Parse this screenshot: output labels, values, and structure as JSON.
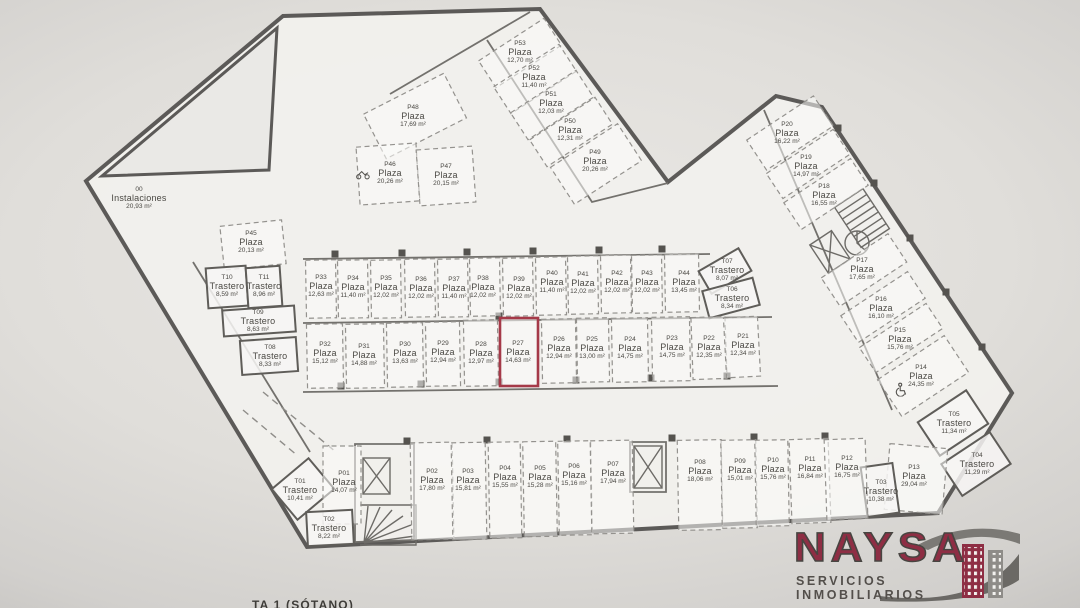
{
  "colors": {
    "wall": "#5c5a58",
    "highlight": "#a53948",
    "logo_maroon": "#8e2e44",
    "logo_gray": "#6b6965",
    "floor": "#f1f0ed",
    "background": "#d6d4d2",
    "label_text": "#4a4843"
  },
  "logo": {
    "name": "NAYSA",
    "tagline": "SERVICIOS INMOBILIARIOS"
  },
  "caption": {
    "text": "TA 1 (SÓTANO)"
  },
  "units": {
    "plaza": "Plaza",
    "trastero": "Trastero",
    "instalaciones": "Instalaciones",
    "area_suffix": "m²"
  },
  "rooms": [
    {
      "id": "P53",
      "kind": "plaza",
      "area": "12,70",
      "label": {
        "x": 520,
        "y": 53
      },
      "rect": {
        "cx": 520,
        "cy": 53,
        "w": 78,
        "h": 32,
        "rot": -33
      }
    },
    {
      "id": "P52",
      "kind": "plaza",
      "area": "11,40",
      "label": {
        "x": 534,
        "y": 78
      },
      "rect": {
        "cx": 535,
        "cy": 79,
        "w": 78,
        "h": 32,
        "rot": -33
      }
    },
    {
      "id": "P51",
      "kind": "plaza",
      "area": "12,03",
      "label": {
        "x": 551,
        "y": 104
      },
      "rect": {
        "cx": 552,
        "cy": 105,
        "w": 78,
        "h": 32,
        "rot": -33
      }
    },
    {
      "id": "P50",
      "kind": "plaza",
      "area": "12,31",
      "label": {
        "x": 570,
        "y": 131
      },
      "rect": {
        "cx": 571,
        "cy": 132,
        "w": 78,
        "h": 32,
        "rot": -33
      }
    },
    {
      "id": "P49",
      "kind": "plaza",
      "area": "20,26",
      "label": {
        "x": 595,
        "y": 162
      },
      "rect": {
        "cx": 596,
        "cy": 164,
        "w": 80,
        "h": 44,
        "rot": -33
      }
    },
    {
      "id": "P48",
      "kind": "plaza",
      "area": "17,69",
      "label": {
        "x": 413,
        "y": 117
      },
      "rect": {
        "cx": 415,
        "cy": 116,
        "w": 90,
        "h": 50,
        "rot": -27
      }
    },
    {
      "id": "P46",
      "kind": "plaza",
      "area": "20,26",
      "label": {
        "x": 390,
        "y": 174
      },
      "rect": {
        "cx": 388,
        "cy": 174,
        "w": 60,
        "h": 58,
        "rot": -4
      },
      "icon": "motorcycle",
      "icon_pos": {
        "x": 363,
        "y": 176
      }
    },
    {
      "id": "P47",
      "kind": "plaza",
      "area": "20,15",
      "label": {
        "x": 446,
        "y": 176
      },
      "rect": {
        "cx": 446,
        "cy": 176,
        "w": 56,
        "h": 56,
        "rot": -4
      }
    },
    {
      "id": "P45",
      "kind": "plaza",
      "area": "20,13",
      "label": {
        "x": 251,
        "y": 243
      },
      "rect": {
        "cx": 253,
        "cy": 245,
        "w": 62,
        "h": 44,
        "rot": -6
      }
    },
    {
      "id": "00",
      "kind": "instalaciones",
      "area": "20,93",
      "label": {
        "x": 139,
        "y": 199
      }
    },
    {
      "id": "T10",
      "kind": "trastero",
      "area": "8,59",
      "label": {
        "x": 227,
        "y": 287
      },
      "rect": {
        "cx": 227,
        "cy": 287,
        "w": 40,
        "h": 40,
        "rot": -4
      }
    },
    {
      "id": "T11",
      "kind": "trastero",
      "area": "8,96",
      "label": {
        "x": 264,
        "y": 287
      },
      "rect": {
        "cx": 264,
        "cy": 287,
        "w": 34,
        "h": 40,
        "rot": -4
      }
    },
    {
      "id": "T09",
      "kind": "trastero",
      "area": "8,63",
      "label": {
        "x": 258,
        "y": 322
      },
      "rect": {
        "cx": 259,
        "cy": 321,
        "w": 72,
        "h": 26,
        "rot": -4
      }
    },
    {
      "id": "T08",
      "kind": "trastero",
      "area": "8,33",
      "label": {
        "x": 270,
        "y": 357
      },
      "rect": {
        "cx": 269,
        "cy": 356,
        "w": 56,
        "h": 34,
        "rot": -4
      }
    },
    {
      "id": "P33",
      "kind": "plaza",
      "area": "12,63",
      "label": {
        "x": 321,
        "y": 287
      },
      "rect": {
        "cx": 321,
        "cy": 289,
        "w": 30,
        "h": 58,
        "rot": -1
      }
    },
    {
      "id": "P34",
      "kind": "plaza",
      "area": "11,40",
      "label": {
        "x": 353,
        "y": 288
      },
      "rect": {
        "cx": 353,
        "cy": 289,
        "w": 30,
        "h": 58,
        "rot": -1
      }
    },
    {
      "id": "P35",
      "kind": "plaza",
      "area": "12,02",
      "label": {
        "x": 386,
        "y": 288
      },
      "rect": {
        "cx": 386,
        "cy": 289,
        "w": 30,
        "h": 58,
        "rot": -1
      }
    },
    {
      "id": "P36",
      "kind": "plaza",
      "area": "12,02",
      "label": {
        "x": 421,
        "y": 289
      },
      "rect": {
        "cx": 420,
        "cy": 288,
        "w": 30,
        "h": 58,
        "rot": -1
      }
    },
    {
      "id": "P37",
      "kind": "plaza",
      "area": "11,40",
      "label": {
        "x": 454,
        "y": 289
      },
      "rect": {
        "cx": 453,
        "cy": 288,
        "w": 30,
        "h": 58,
        "rot": -1
      }
    },
    {
      "id": "P38",
      "kind": "plaza",
      "area": "12,02",
      "label": {
        "x": 483,
        "y": 288
      },
      "rect": {
        "cx": 485,
        "cy": 287,
        "w": 30,
        "h": 58,
        "rot": -1
      }
    },
    {
      "id": "P39",
      "kind": "plaza",
      "area": "12,02",
      "label": {
        "x": 519,
        "y": 289
      },
      "rect": {
        "cx": 518,
        "cy": 287,
        "w": 30,
        "h": 58,
        "rot": -1
      }
    },
    {
      "id": "P40",
      "kind": "plaza",
      "area": "11,40",
      "label": {
        "x": 552,
        "y": 283
      },
      "rect": {
        "cx": 551,
        "cy": 286,
        "w": 30,
        "h": 58,
        "rot": -1
      }
    },
    {
      "id": "P41",
      "kind": "plaza",
      "area": "12,02",
      "label": {
        "x": 583,
        "y": 284
      },
      "rect": {
        "cx": 583,
        "cy": 285,
        "w": 30,
        "h": 58,
        "rot": -1
      }
    },
    {
      "id": "P42",
      "kind": "plaza",
      "area": "12,02",
      "label": {
        "x": 617,
        "y": 283
      },
      "rect": {
        "cx": 616,
        "cy": 284,
        "w": 30,
        "h": 58,
        "rot": -1
      }
    },
    {
      "id": "P43",
      "kind": "plaza",
      "area": "12,02",
      "label": {
        "x": 647,
        "y": 283
      },
      "rect": {
        "cx": 647,
        "cy": 284,
        "w": 30,
        "h": 58,
        "rot": -1
      }
    },
    {
      "id": "P44",
      "kind": "plaza",
      "area": "13,45",
      "label": {
        "x": 684,
        "y": 283
      },
      "rect": {
        "cx": 682,
        "cy": 283,
        "w": 34,
        "h": 58,
        "rot": -1
      }
    },
    {
      "id": "T07",
      "kind": "trastero",
      "area": "8,07",
      "label": {
        "x": 727,
        "y": 271
      },
      "rect": {
        "cx": 725,
        "cy": 271,
        "w": 46,
        "h": 26,
        "rot": -30
      }
    },
    {
      "id": "T06",
      "kind": "trastero",
      "area": "8,34",
      "label": {
        "x": 732,
        "y": 299
      },
      "rect": {
        "cx": 731,
        "cy": 298,
        "w": 52,
        "h": 28,
        "rot": -15
      }
    },
    {
      "id": "P32",
      "kind": "plaza",
      "area": "15,12",
      "label": {
        "x": 325,
        "y": 354
      },
      "rect": {
        "cx": 325,
        "cy": 356,
        "w": 36,
        "h": 64,
        "rot": -1
      }
    },
    {
      "id": "P31",
      "kind": "plaza",
      "area": "14,88",
      "label": {
        "x": 364,
        "y": 356
      },
      "rect": {
        "cx": 365,
        "cy": 356,
        "w": 38,
        "h": 64,
        "rot": -1
      }
    },
    {
      "id": "P30",
      "kind": "plaza",
      "area": "13,63",
      "label": {
        "x": 405,
        "y": 354
      },
      "rect": {
        "cx": 405,
        "cy": 355,
        "w": 36,
        "h": 64,
        "rot": -1
      }
    },
    {
      "id": "P29",
      "kind": "plaza",
      "area": "12,94",
      "label": {
        "x": 443,
        "y": 353
      },
      "rect": {
        "cx": 443,
        "cy": 354,
        "w": 34,
        "h": 64,
        "rot": -1
      }
    },
    {
      "id": "P28",
      "kind": "plaza",
      "area": "12,97",
      "label": {
        "x": 481,
        "y": 354
      },
      "rect": {
        "cx": 481,
        "cy": 353,
        "w": 34,
        "h": 66,
        "rot": -1
      }
    },
    {
      "id": "P27",
      "kind": "plaza",
      "area": "14,63",
      "label": {
        "x": 518,
        "y": 353
      },
      "rect": {
        "cx": 519,
        "cy": 352,
        "w": 38,
        "h": 68,
        "rot": 0
      },
      "highlight": true
    },
    {
      "id": "P26",
      "kind": "plaza",
      "area": "12,94",
      "label": {
        "x": 559,
        "y": 349
      },
      "rect": {
        "cx": 559,
        "cy": 351,
        "w": 34,
        "h": 64,
        "rot": -1
      }
    },
    {
      "id": "P25",
      "kind": "plaza",
      "area": "13,00",
      "label": {
        "x": 592,
        "y": 349
      },
      "rect": {
        "cx": 593,
        "cy": 350,
        "w": 32,
        "h": 64,
        "rot": -1
      }
    },
    {
      "id": "P24",
      "kind": "plaza",
      "area": "14,75",
      "label": {
        "x": 630,
        "y": 349
      },
      "rect": {
        "cx": 630,
        "cy": 350,
        "w": 36,
        "h": 64,
        "rot": -1
      }
    },
    {
      "id": "P23",
      "kind": "plaza",
      "area": "14,75",
      "label": {
        "x": 672,
        "y": 348
      },
      "rect": {
        "cx": 671,
        "cy": 349,
        "w": 38,
        "h": 64,
        "rot": -1
      }
    },
    {
      "id": "P22",
      "kind": "plaza",
      "area": "12,35",
      "label": {
        "x": 709,
        "y": 348
      },
      "rect": {
        "cx": 709,
        "cy": 348,
        "w": 34,
        "h": 62,
        "rot": -2
      }
    },
    {
      "id": "P21",
      "kind": "plaza",
      "area": "12,34",
      "label": {
        "x": 743,
        "y": 346
      },
      "rect": {
        "cx": 742,
        "cy": 347,
        "w": 34,
        "h": 60,
        "rot": -3
      }
    },
    {
      "id": "P20",
      "kind": "plaza",
      "area": "16,22",
      "label": {
        "x": 787,
        "y": 134
      },
      "rect": {
        "cx": 790,
        "cy": 133,
        "w": 80,
        "h": 36,
        "rot": -33.5
      }
    },
    {
      "id": "P19",
      "kind": "plaza",
      "area": "14,97",
      "label": {
        "x": 806,
        "y": 167
      },
      "rect": {
        "cx": 808,
        "cy": 164,
        "w": 80,
        "h": 30,
        "rot": -33.5
      }
    },
    {
      "id": "P18",
      "kind": "plaza",
      "area": "16,55",
      "label": {
        "x": 824,
        "y": 196
      },
      "rect": {
        "cx": 826,
        "cy": 194,
        "w": 80,
        "h": 32,
        "rot": -33.5
      }
    },
    {
      "id": "P17",
      "kind": "plaza",
      "area": "17,65",
      "label": {
        "x": 862,
        "y": 270
      },
      "rect": {
        "cx": 864,
        "cy": 270,
        "w": 80,
        "h": 34,
        "rot": -33.5
      }
    },
    {
      "id": "P16",
      "kind": "plaza",
      "area": "16,10",
      "label": {
        "x": 881,
        "y": 309
      },
      "rect": {
        "cx": 883,
        "cy": 307,
        "w": 80,
        "h": 32,
        "rot": -33.5
      }
    },
    {
      "id": "P15",
      "kind": "plaza",
      "area": "15,76",
      "label": {
        "x": 900,
        "y": 340
      },
      "rect": {
        "cx": 901,
        "cy": 338,
        "w": 80,
        "h": 30,
        "rot": -33.5
      }
    },
    {
      "id": "P14",
      "kind": "plaza",
      "area": "24,35",
      "label": {
        "x": 921,
        "y": 377
      },
      "rect": {
        "cx": 923,
        "cy": 376,
        "w": 80,
        "h": 44,
        "rot": -33.5
      },
      "icon": "wheelchair",
      "icon_pos": {
        "x": 901,
        "y": 392
      }
    },
    {
      "id": "T05",
      "kind": "trastero",
      "area": "11,34",
      "label": {
        "x": 954,
        "y": 424
      },
      "rect": {
        "cx": 953,
        "cy": 423,
        "w": 58,
        "h": 40,
        "rot": -33.5
      }
    },
    {
      "id": "T04",
      "kind": "trastero",
      "area": "11,29",
      "label": {
        "x": 977,
        "y": 465
      },
      "rect": {
        "cx": 976,
        "cy": 464,
        "w": 58,
        "h": 38,
        "rot": -33.5
      }
    },
    {
      "id": "P13",
      "kind": "plaza",
      "area": "29,04",
      "label": {
        "x": 914,
        "y": 477
      },
      "rect": {
        "cx": 916,
        "cy": 479,
        "w": 58,
        "h": 66,
        "rot": 5
      }
    },
    {
      "id": "T03",
      "kind": "trastero",
      "area": "10,38",
      "label": {
        "x": 881,
        "y": 492
      },
      "rect": {
        "cx": 880,
        "cy": 490,
        "w": 32,
        "h": 50,
        "rot": -8
      }
    },
    {
      "id": "T01",
      "kind": "trastero",
      "area": "10,41",
      "label": {
        "x": 300,
        "y": 491
      },
      "rect": {
        "cx": 303,
        "cy": 489,
        "w": 48,
        "h": 40,
        "rot": -40
      }
    },
    {
      "id": "P01",
      "kind": "plaza",
      "area": "14,07",
      "label": {
        "x": 344,
        "y": 483
      },
      "rect": {
        "cx": 342,
        "cy": 485,
        "w": 38,
        "h": 78,
        "rot": 0
      }
    },
    {
      "id": "T02",
      "kind": "trastero",
      "area": "8,22",
      "label": {
        "x": 329,
        "y": 529
      },
      "rect": {
        "cx": 330,
        "cy": 528,
        "w": 46,
        "h": 34,
        "rot": -3
      }
    },
    {
      "id": "P02",
      "kind": "plaza",
      "area": "17,80",
      "label": {
        "x": 432,
        "y": 481
      },
      "rect": {
        "cx": 432,
        "cy": 491,
        "w": 42,
        "h": 97,
        "rot": -1
      }
    },
    {
      "id": "P03",
      "kind": "plaza",
      "area": "15,81",
      "label": {
        "x": 468,
        "y": 481
      },
      "rect": {
        "cx": 469,
        "cy": 491,
        "w": 34,
        "h": 97,
        "rot": -1
      }
    },
    {
      "id": "P04",
      "kind": "plaza",
      "area": "15,55",
      "label": {
        "x": 505,
        "y": 478
      },
      "rect": {
        "cx": 505,
        "cy": 490,
        "w": 32,
        "h": 96,
        "rot": -1
      }
    },
    {
      "id": "P05",
      "kind": "plaza",
      "area": "15,28",
      "label": {
        "x": 540,
        "y": 478
      },
      "rect": {
        "cx": 540,
        "cy": 489,
        "w": 33,
        "h": 95,
        "rot": -1
      }
    },
    {
      "id": "P06",
      "kind": "plaza",
      "area": "15,16",
      "label": {
        "x": 574,
        "y": 476
      },
      "rect": {
        "cx": 575,
        "cy": 488,
        "w": 33,
        "h": 94,
        "rot": -1
      }
    },
    {
      "id": "P07",
      "kind": "plaza",
      "area": "17,94",
      "label": {
        "x": 613,
        "y": 474
      },
      "rect": {
        "cx": 612,
        "cy": 487,
        "w": 42,
        "h": 93,
        "rot": -1
      }
    },
    {
      "id": "P08",
      "kind": "plaza",
      "area": "18,06",
      "label": {
        "x": 700,
        "y": 472
      },
      "rect": {
        "cx": 700,
        "cy": 485,
        "w": 44,
        "h": 90,
        "rot": -1
      }
    },
    {
      "id": "P09",
      "kind": "plaza",
      "area": "15,01",
      "label": {
        "x": 740,
        "y": 471
      },
      "rect": {
        "cx": 739,
        "cy": 484,
        "w": 35,
        "h": 88,
        "rot": -1
      }
    },
    {
      "id": "P10",
      "kind": "plaza",
      "area": "15,76",
      "label": {
        "x": 773,
        "y": 470
      },
      "rect": {
        "cx": 772,
        "cy": 483,
        "w": 33,
        "h": 86,
        "rot": -1
      }
    },
    {
      "id": "P11",
      "kind": "plaza",
      "area": "16,84",
      "label": {
        "x": 810,
        "y": 469
      },
      "rect": {
        "cx": 810,
        "cy": 481,
        "w": 39,
        "h": 84,
        "rot": -2
      }
    },
    {
      "id": "P12",
      "kind": "plaza",
      "area": "16,75",
      "label": {
        "x": 847,
        "y": 468
      },
      "rect": {
        "cx": 846,
        "cy": 479,
        "w": 41,
        "h": 80,
        "rot": -2
      }
    }
  ]
}
